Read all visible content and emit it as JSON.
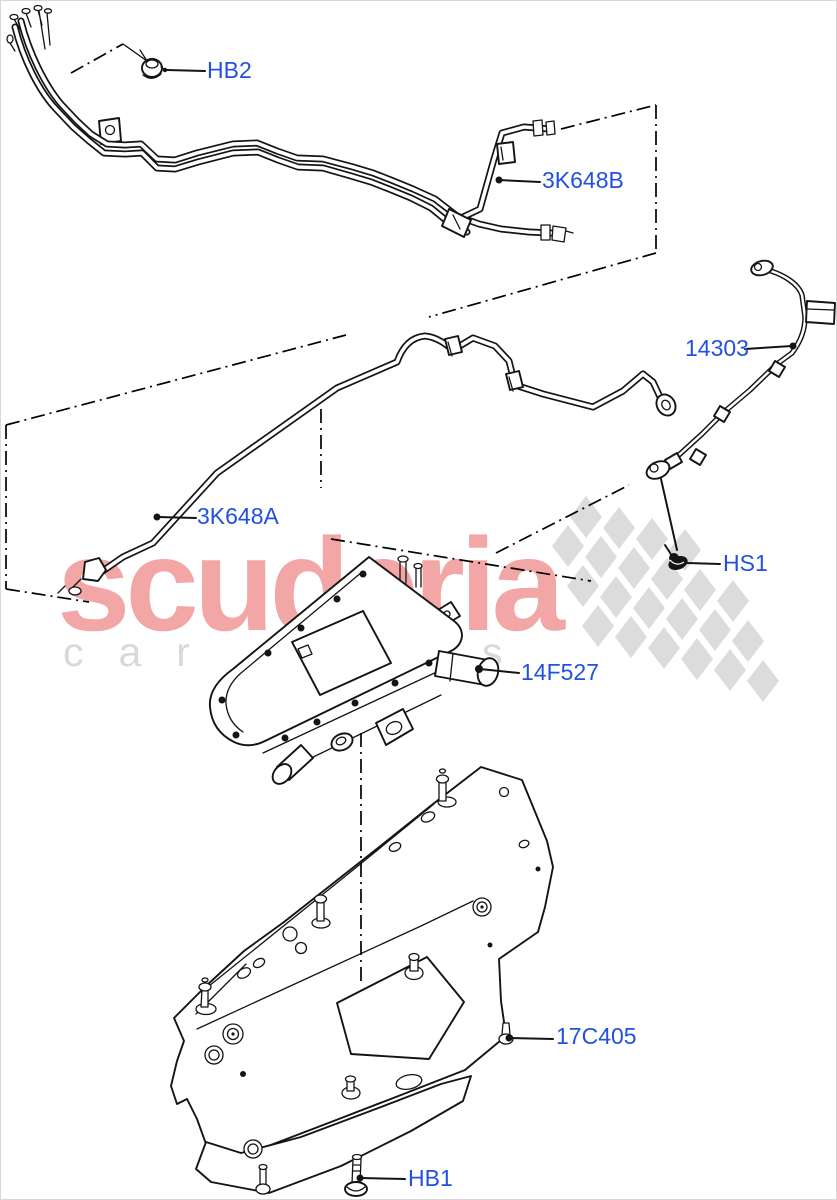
{
  "watermark": {
    "brand": "scuderia",
    "tagline": "car parts",
    "brand_color": "#f3a6a6",
    "tagline_color": "#d9d9d9",
    "flag_color": "#dcdcdc"
  },
  "labels": {
    "hb2": "HB2",
    "pipe_rear": "3K648B",
    "battery_cable": "14303",
    "pipe_front": "3K648A",
    "screw_hs1": "HS1",
    "heater_unit": "14F527",
    "mounting_bracket": "17C405",
    "bolt_hb1": "HB1"
  },
  "style": {
    "label_color": "#2350e0",
    "line_color": "#141414",
    "background": "#ffffff"
  }
}
